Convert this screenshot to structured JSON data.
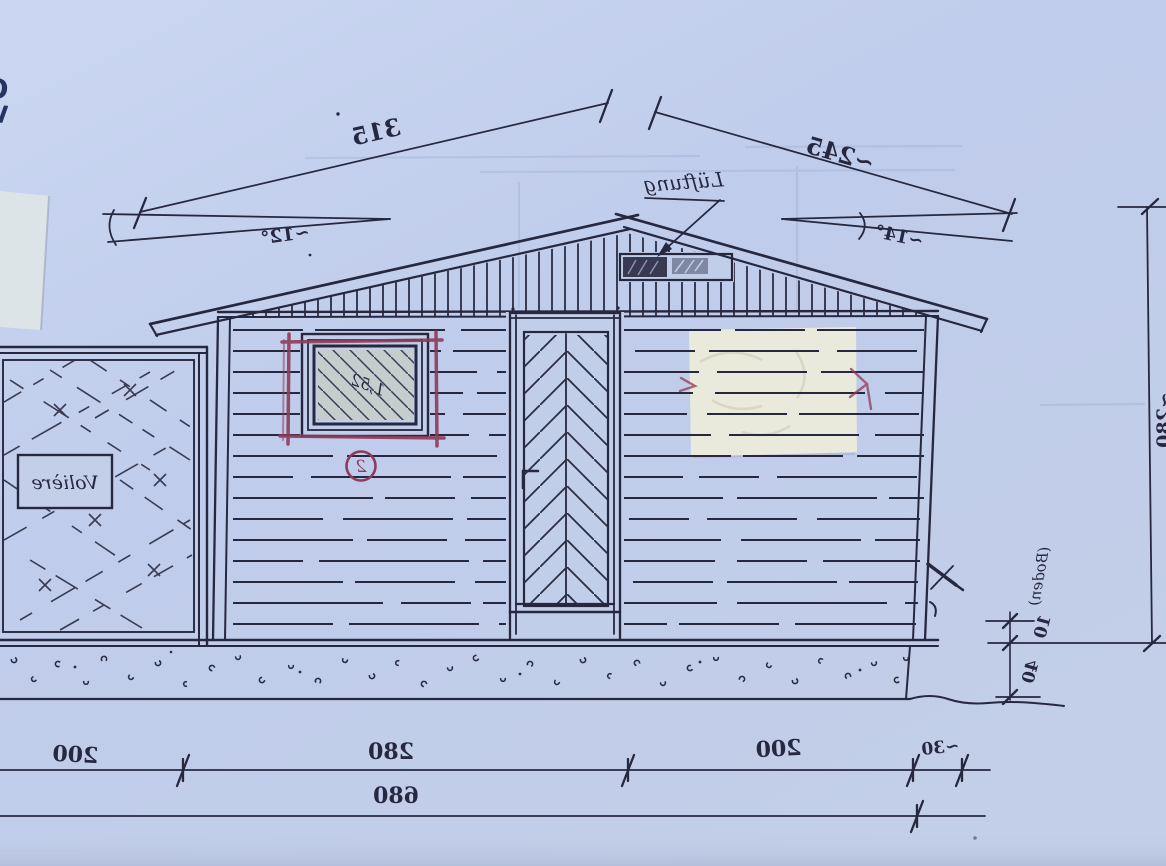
{
  "photo": {
    "corner_text_line1": "O",
    "corner_text_line2": "W"
  },
  "roof": {
    "left_length": "315",
    "right_length": "~245",
    "left_angle": "~12°",
    "right_angle": "~14°",
    "vent_label": "Lüftung"
  },
  "window": {
    "note": "1,52",
    "marker": "2"
  },
  "aviary": {
    "label": "Volière"
  },
  "dims": {
    "bottom_left": "200",
    "bottom_middle": "280",
    "bottom_right": "200",
    "bottom_offset": "~30",
    "bottom_total": "680",
    "right_floor": "10",
    "right_floor_note": "(Boden)",
    "right_plinth": "40",
    "right_height": "~280"
  },
  "colors": {
    "paper": "#c2cfe9",
    "ink": "#262840",
    "marker_red": "#8f3a58"
  }
}
